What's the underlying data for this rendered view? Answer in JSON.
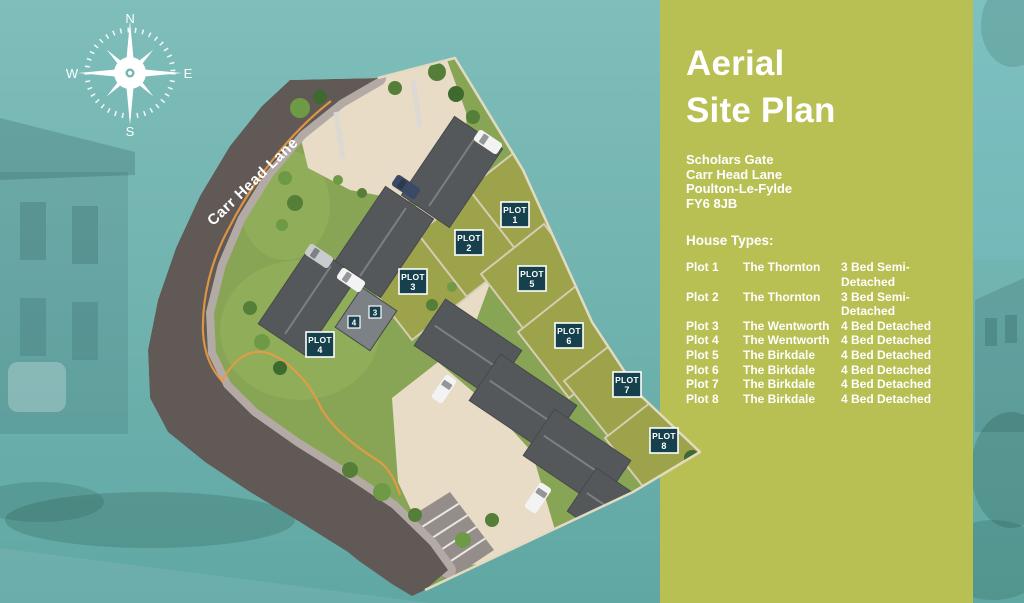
{
  "colors": {
    "teal_background": "#72b4b0",
    "panel_olive": "#b8bf53",
    "text_white": "#ffffff",
    "plot_badge_background": "#17404d",
    "plot_badge_border": "#ffffff",
    "road_gray": "#615955",
    "driveway_beige": "#e8dcc6",
    "lawn_green": "#88a455",
    "garden_olive": "#9ca34b",
    "roof_gray": "#54585b",
    "boundary_orange": "#eb9a43"
  },
  "compass": {
    "north": "N",
    "east": "E",
    "south": "S",
    "west": "W"
  },
  "map": {
    "road_label": "Carr Head Lane",
    "badges": [
      {
        "line1": "PLOT",
        "line2": "1"
      },
      {
        "line1": "PLOT",
        "line2": "2"
      },
      {
        "line1": "PLOT",
        "line2": "3"
      },
      {
        "line1": "PLOT",
        "line2": "4"
      },
      {
        "line1": "PLOT",
        "line2": "5"
      },
      {
        "line1": "PLOT",
        "line2": "6"
      },
      {
        "line1": "PLOT",
        "line2": "7"
      },
      {
        "line1": "PLOT",
        "line2": "8"
      }
    ],
    "mini_badges": [
      "4",
      "3"
    ]
  },
  "panel": {
    "title_line1": "Aerial",
    "title_line2": "Site Plan",
    "address_lines": [
      "Scholars Gate",
      "Carr Head Lane",
      "Poulton-Le-Fylde",
      "FY6 8JB"
    ],
    "house_types_label": "House Types:",
    "plots": [
      {
        "plot": "Plot 1",
        "name": "The Thornton",
        "type": "3 Bed Semi-Detached"
      },
      {
        "plot": "Plot 2",
        "name": "The Thornton",
        "type": "3 Bed Semi-Detached"
      },
      {
        "plot": "Plot 3",
        "name": "The Wentworth",
        "type": "4 Bed Detached"
      },
      {
        "plot": "Plot 4",
        "name": "The Wentworth",
        "type": "4 Bed Detached"
      },
      {
        "plot": "Plot 5",
        "name": "The Birkdale",
        "type": "4 Bed Detached"
      },
      {
        "plot": "Plot 6",
        "name": "The Birkdale",
        "type": "4 Bed Detached"
      },
      {
        "plot": "Plot 7",
        "name": "The Birkdale",
        "type": "4 Bed Detached"
      },
      {
        "plot": "Plot 8",
        "name": "The Birkdale",
        "type": "4 Bed Detached"
      }
    ]
  }
}
